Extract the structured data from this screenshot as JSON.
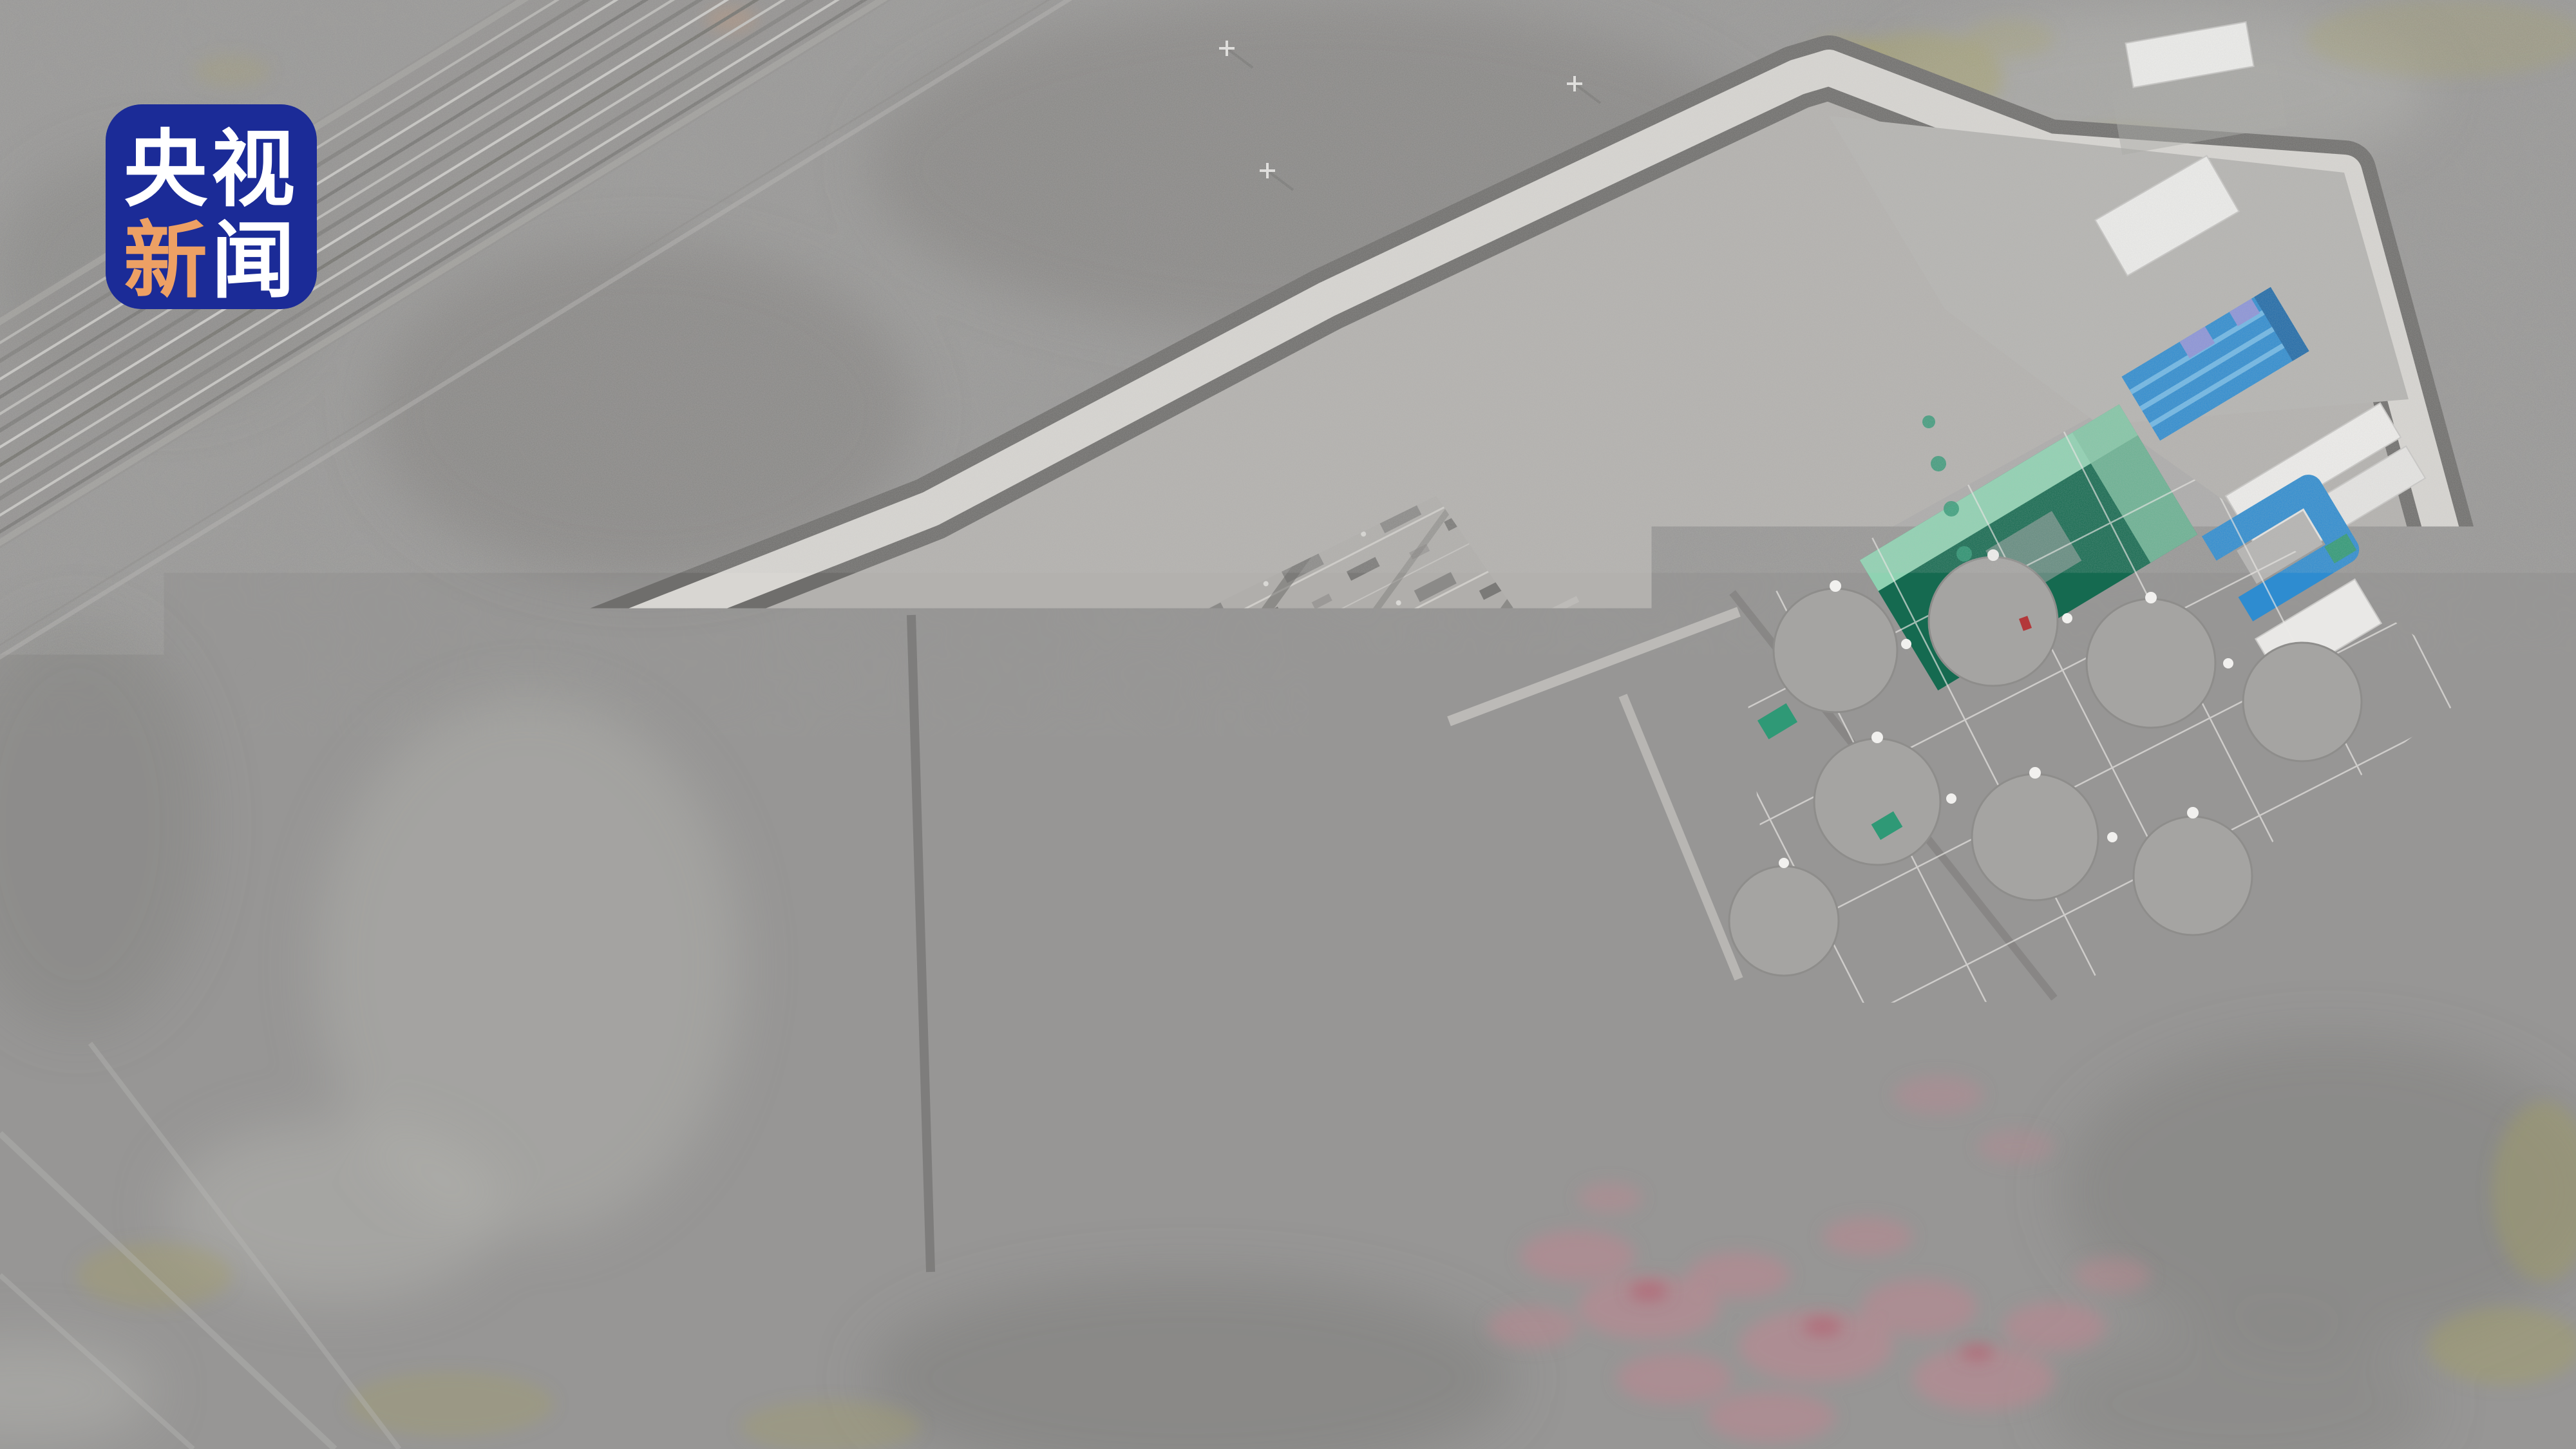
{
  "watermark": {
    "icon": "cctv-news-logo",
    "top_text": "央视",
    "bottom_first": "新",
    "bottom_second": "闻",
    "bg_color": "#1b2b97",
    "text_color": "#ffffff",
    "accent_color": "#eda064"
  },
  "scene": {
    "description": "Aerial drone photo of a large UHV converter station compound in gray desert terrain; railway lines cross the upper-left, green valve halls and blue-roof buildings stand in the compound, pink and olive patches mottle the surrounding ground.",
    "colors": {
      "terrain_base": "#979695",
      "terrain_dark": "#7b7a78",
      "terrain_light": "#b4b3b0",
      "wall": "#d8d6d2",
      "road": "#6f6e6c",
      "pad": "#b3b1ae",
      "pad_left": "#b9b7b4",
      "pad_mid": "#b0aeab",
      "pad_pond": "#acabaa",
      "pad_topright": "#b5b4b1",
      "green_dark": "#156a50",
      "green_mid": "#228a66",
      "green_mint": "#8fd2b2",
      "teal": "#2f9976",
      "blue_roof": "#2e8cd0",
      "blue_light": "#6db7e6",
      "periwinkle": "#8b93d8",
      "white_building": "#ededeb",
      "pink": "#c08691",
      "pink_strong": "#b26070",
      "olive": "#a6a061",
      "salmon": "#d99a6c",
      "red_equipment": "#b3383a"
    }
  }
}
